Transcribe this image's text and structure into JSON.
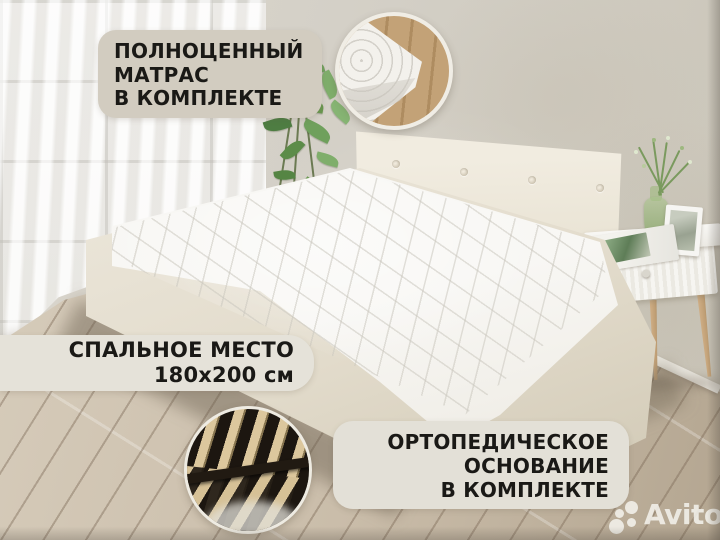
{
  "badges": {
    "mattress_included": {
      "lines": [
        "ПОЛНОЦЕННЫЙ",
        "МАТРАС",
        "В КОМПЛЕКТЕ"
      ],
      "bg": "#d2ccc0",
      "text_color": "#1a1916"
    },
    "sleeping_size": {
      "lines": [
        "СПАЛЬНОЕ МЕСТО",
        "180x200 см"
      ],
      "bg": "#e5e2d9",
      "text_color": "#1a1916"
    },
    "orthopedic_base": {
      "lines": [
        "ОРТОПЕДИЧЕСКОЕ",
        "ОСНОВАНИЕ",
        "В КОМПЛЕКТЕ"
      ],
      "bg": "#e3e0d7",
      "text_color": "#1a1916"
    }
  },
  "watermark": {
    "text": "Avito",
    "color": "rgba(245,243,237,0.85)"
  },
  "insets": {
    "top_right": "mattress-quilting-closeup",
    "bottom_left": "orthopedic-slat-base-closeup"
  },
  "scene": {
    "subject": "double bed with white quilted mattress, tufted cream headboard, white nightstand, sheer curtained window, wood laminate floor",
    "colors": {
      "wall": "#d2cec5",
      "floor": "#c8bba8",
      "bed_frame": "#e9e4d8",
      "mattress": "#f6f5f1",
      "plant_green": "#6b9c58",
      "slat_wood": "#dcc79d"
    }
  }
}
